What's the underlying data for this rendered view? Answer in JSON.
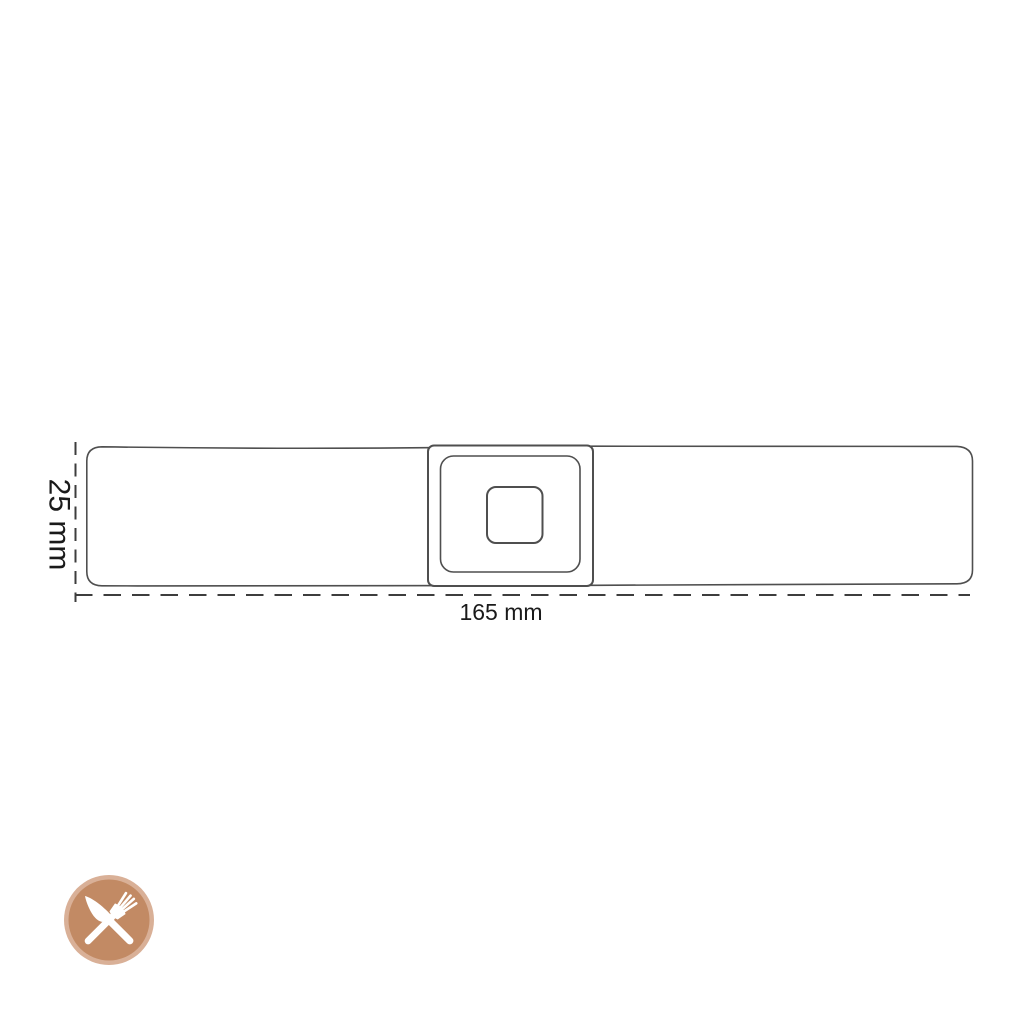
{
  "diagram": {
    "height_label": "25 mm",
    "width_label": "165 mm",
    "outline_color": "#4f4f4f",
    "dimension_line_color": "#3d3d3d",
    "label_text_color": "#1a1a1a",
    "background_color": "#ffffff"
  },
  "logo": {
    "icon": "crossed-knife-and-fork",
    "ring_color": "#d9b097",
    "disc_color": "#c28a64",
    "cutlery_color": "#ffffff"
  }
}
